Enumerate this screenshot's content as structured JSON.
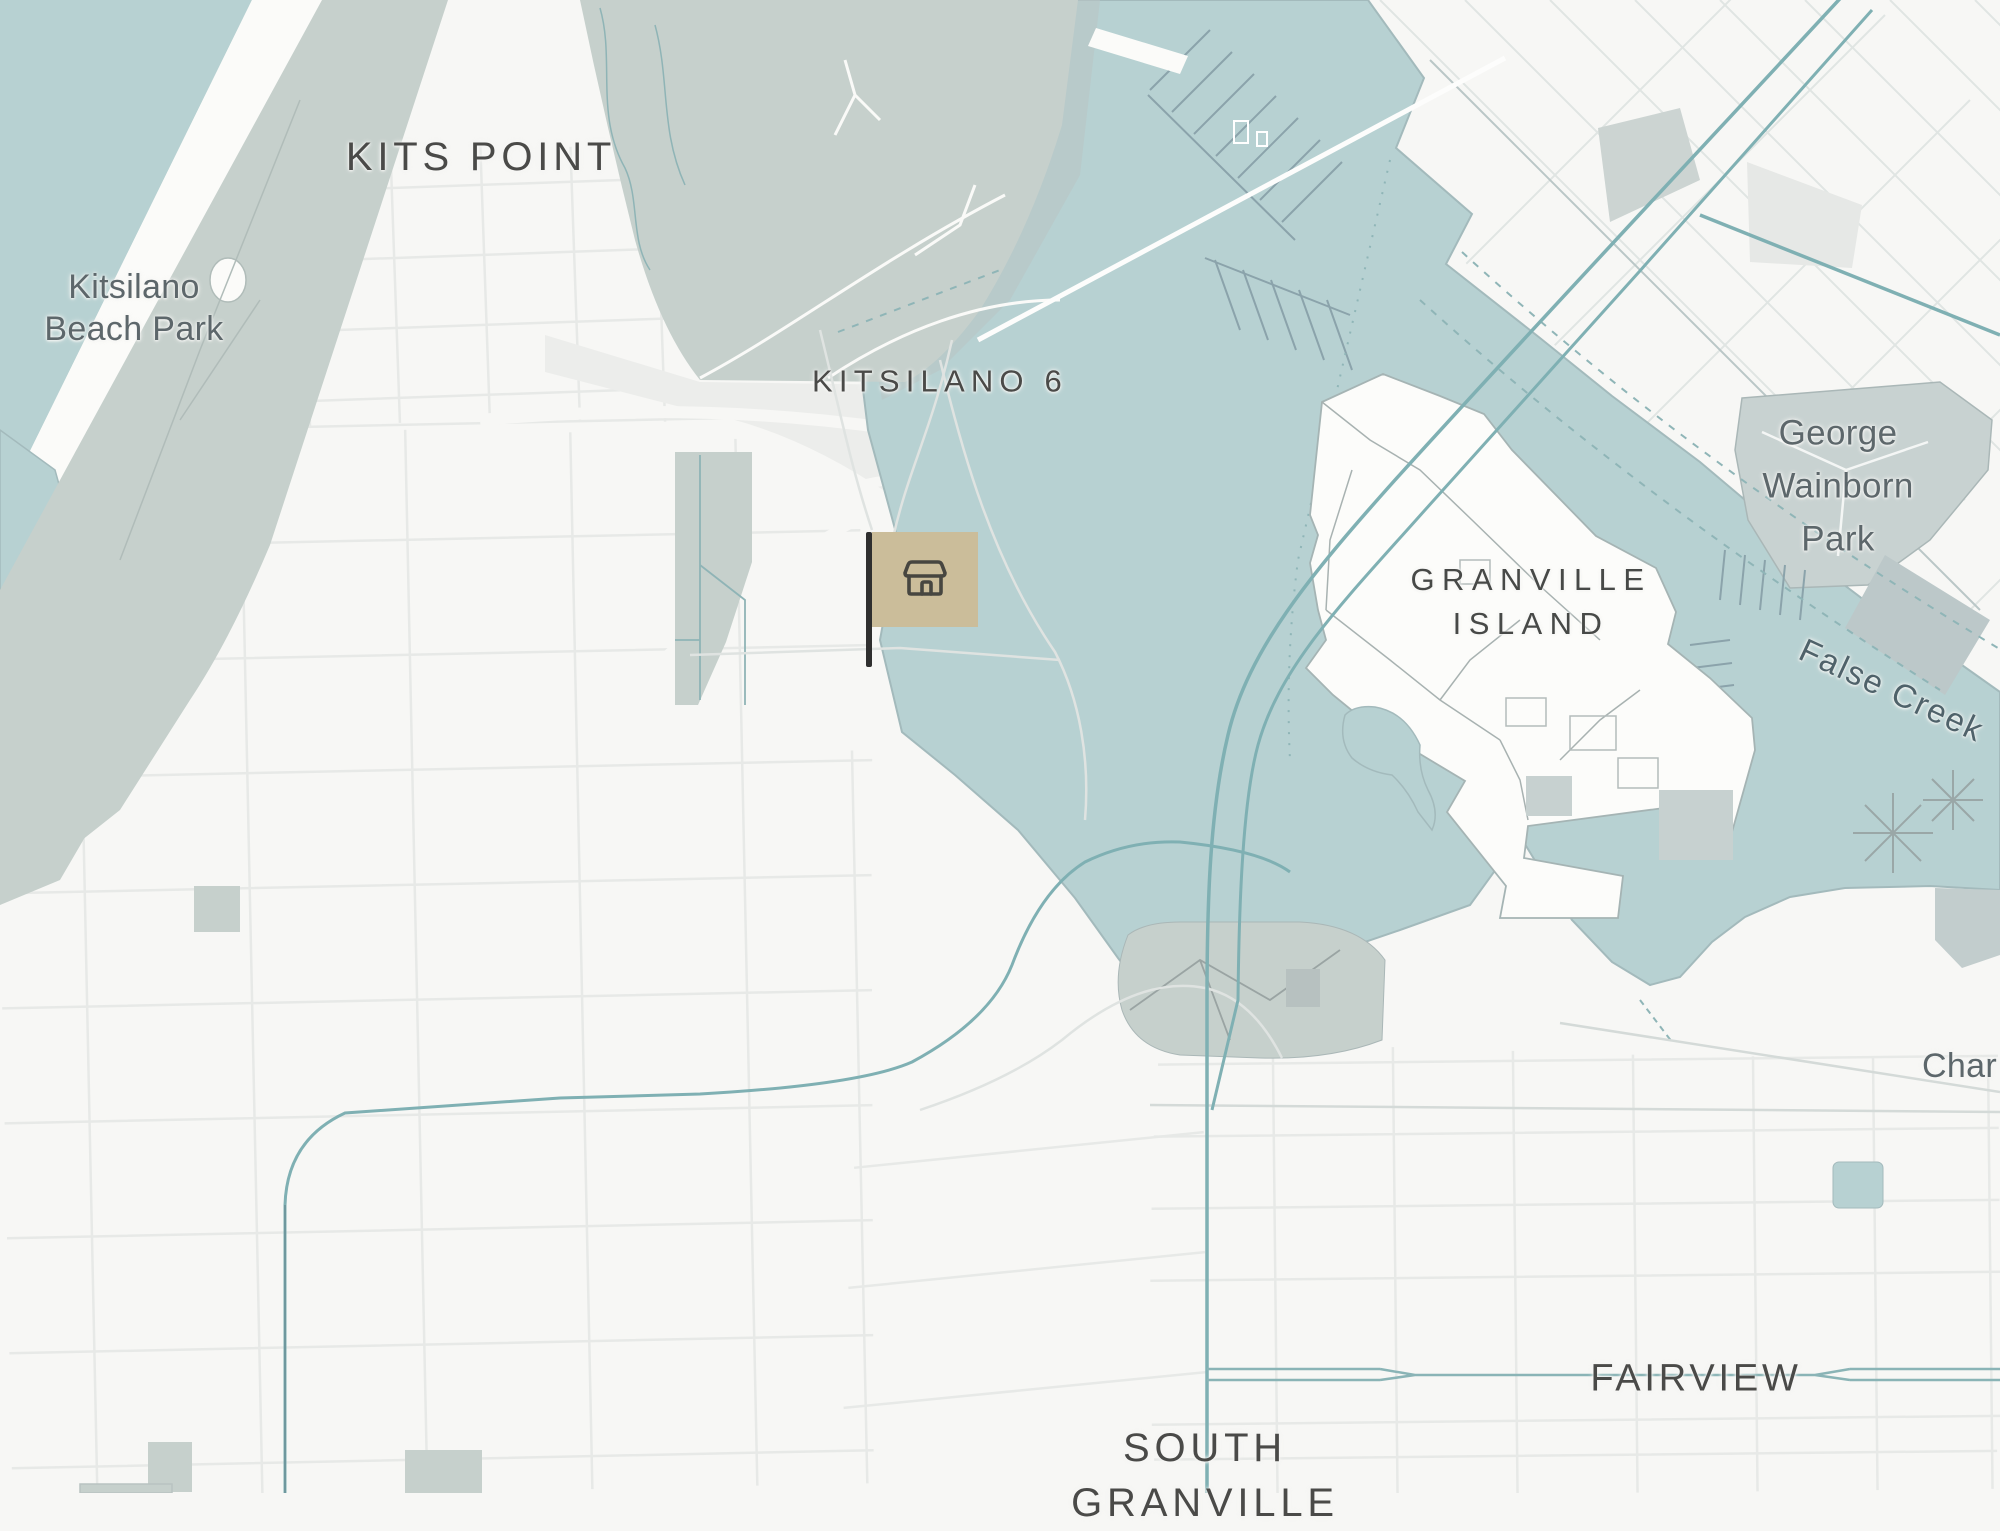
{
  "map": {
    "labels": {
      "kits_point": "KITS POINT",
      "kitsilano_beach_park_line1": "Kitsilano",
      "kitsilano_beach_park_line2": "Beach Park",
      "kitsilano_6": "KITSILANO 6",
      "granville_island_line1": "GRANVILLE",
      "granville_island_line2": "ISLAND",
      "george_wainborn_park_line1": "George",
      "george_wainborn_park_line2": "Wainborn",
      "george_wainborn_park_line3": "Park",
      "false_creek": "False Creek",
      "fairview": "FAIRVIEW",
      "south_granville_line1": "SOUTH",
      "south_granville_line2": "GRANVILLE",
      "charleson_partial": "Char"
    },
    "marker": {
      "kind": "flag-marker",
      "icon": "storefront-icon",
      "flag_color": "#cbbd9a",
      "pole_color": "#2f2f2f",
      "icon_color": "#474640"
    },
    "colors": {
      "land": "#f7f7f5",
      "land_secondary": "#ecedeb",
      "water": "#b7d1d2",
      "park_green": "#c6d0cc",
      "park_gray": "#c8d2d1",
      "route_highlight": "#7fb0b3",
      "label_district": "#4a4a48",
      "label_park": "#5d676b",
      "label_water": "#4f626a"
    }
  }
}
